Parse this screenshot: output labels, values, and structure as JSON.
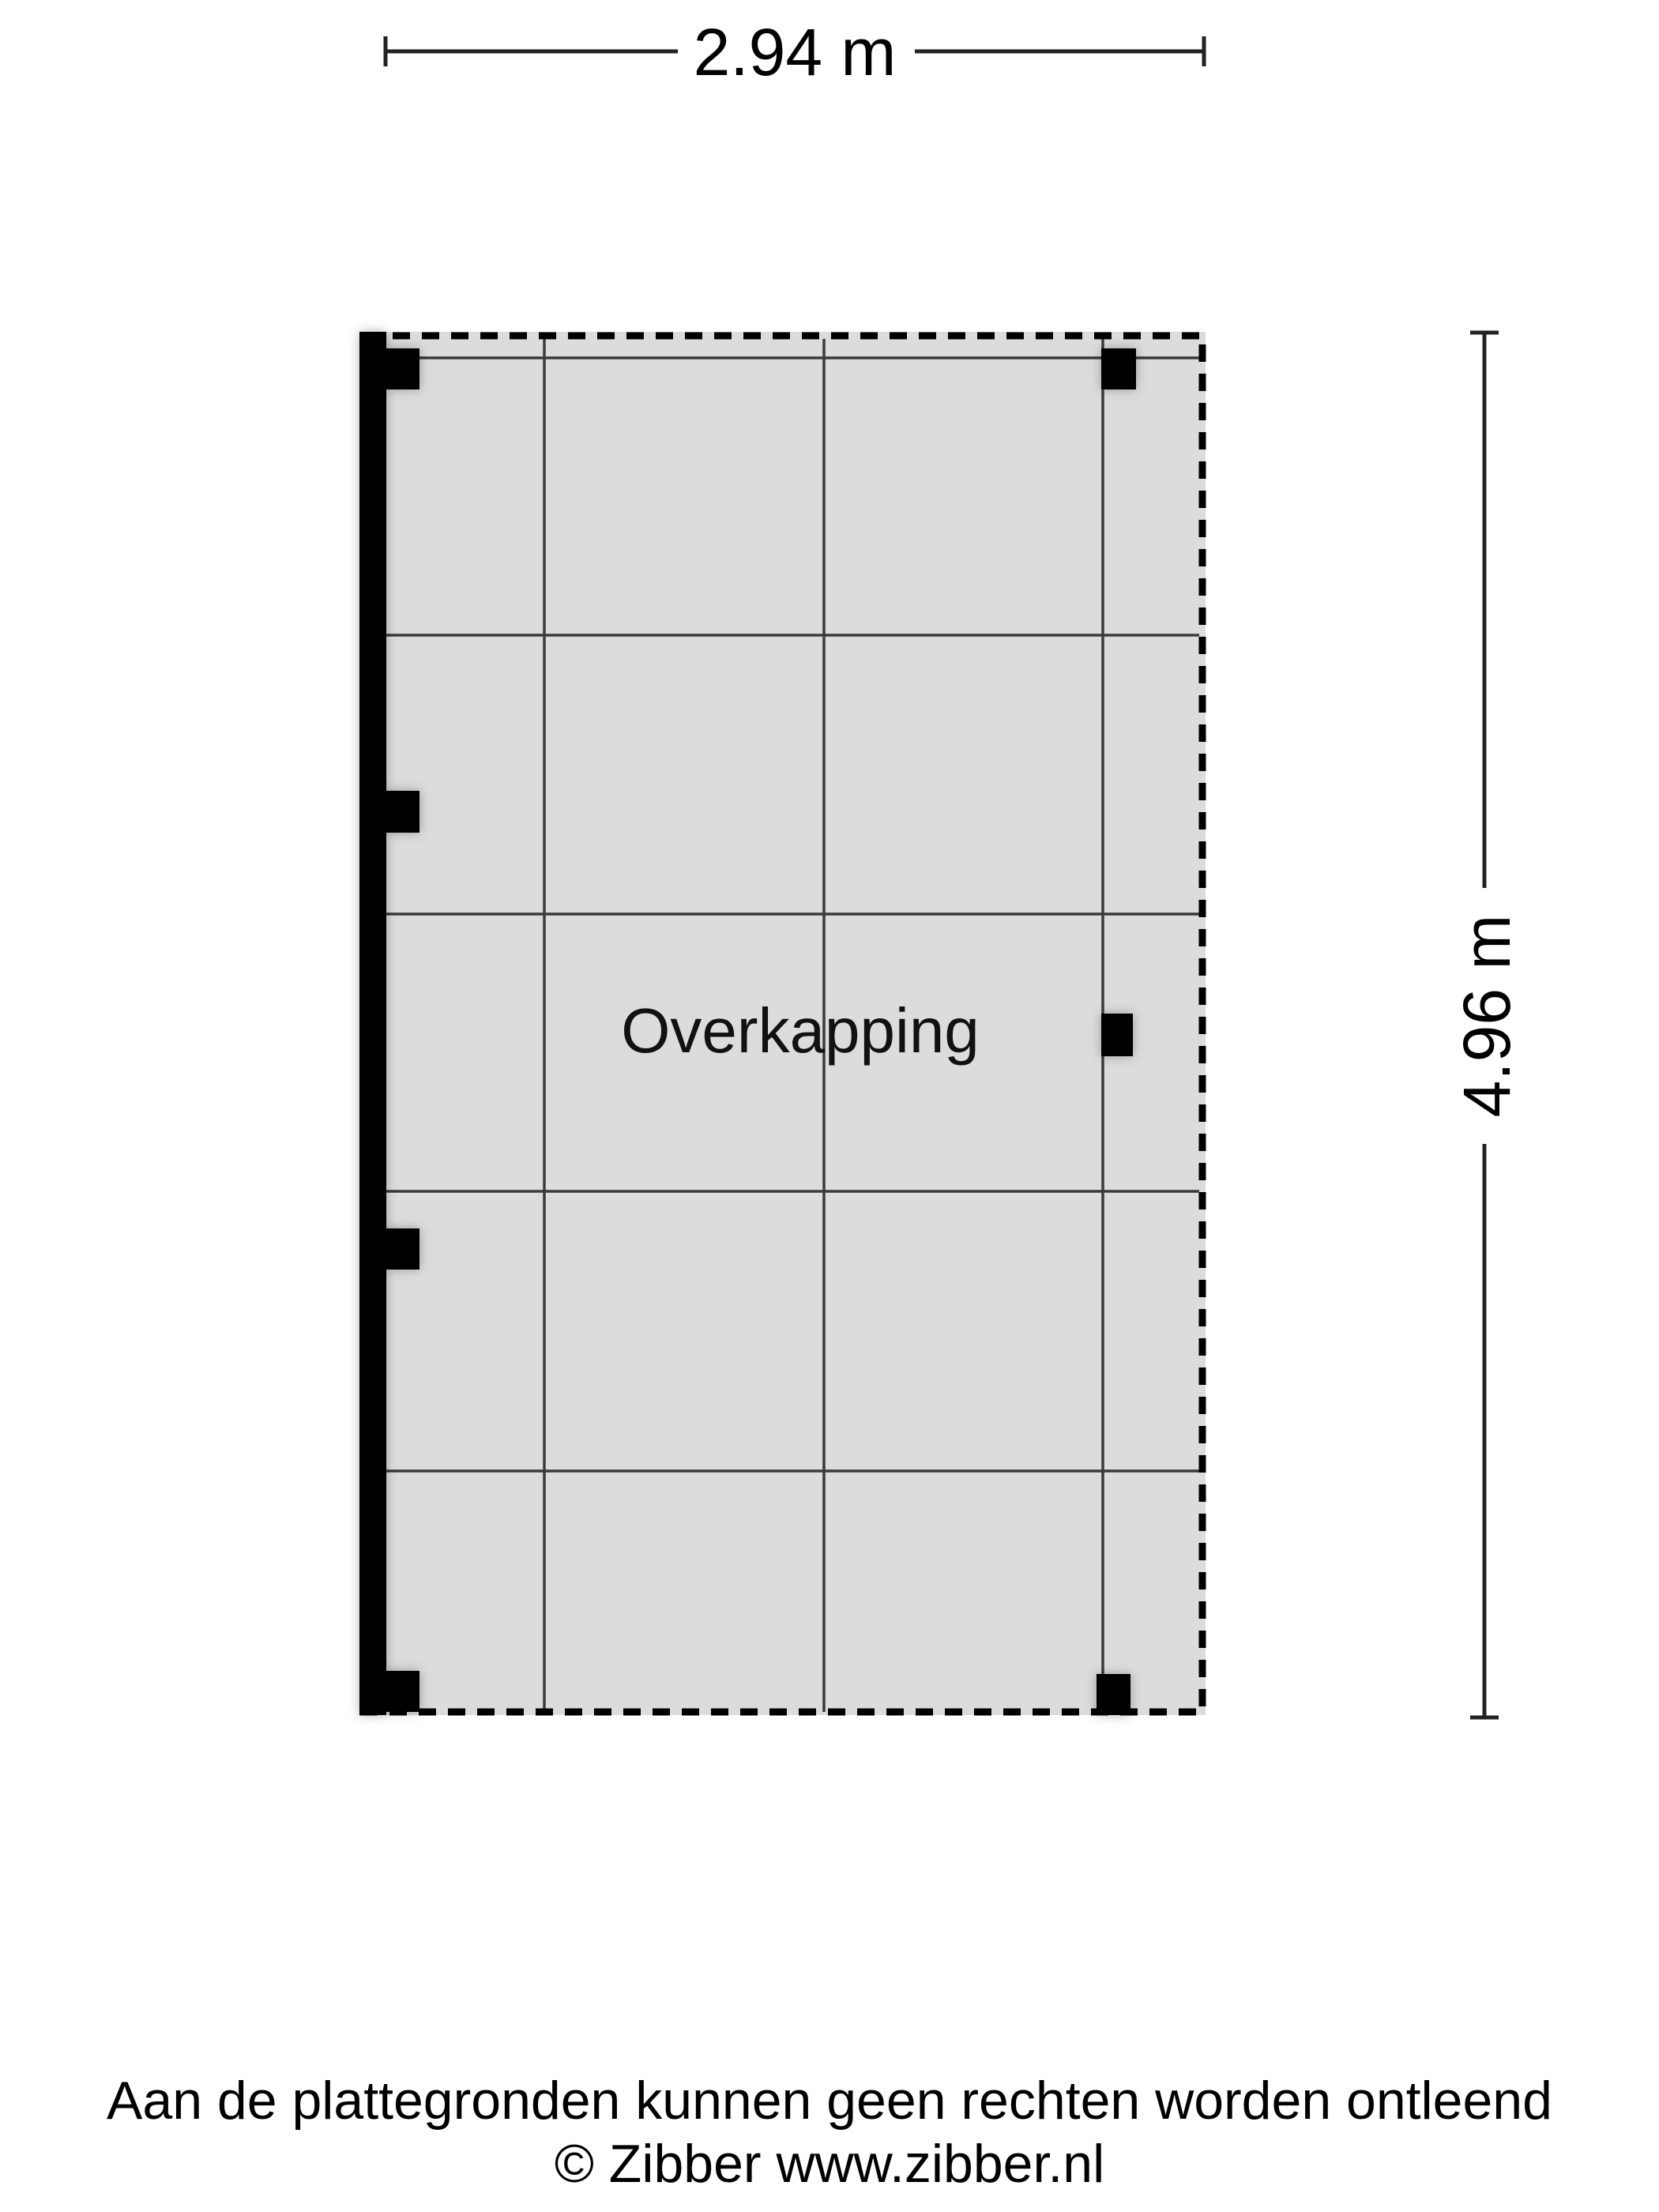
{
  "floorplan": {
    "room_label": "Overkapping",
    "width_dimension": {
      "label": "2.94 m"
    },
    "height_dimension": {
      "label": "4.96 m"
    },
    "colors": {
      "floor_fill": "#dcdcdc",
      "outline": "#000000",
      "grid_line": "#3a3a3a",
      "wall": "#000000"
    }
  },
  "footer": {
    "disclaimer": "Aan de plattegronden kunnen geen rechten worden ontleend",
    "copyright": "© Zibber www.zibber.nl"
  }
}
